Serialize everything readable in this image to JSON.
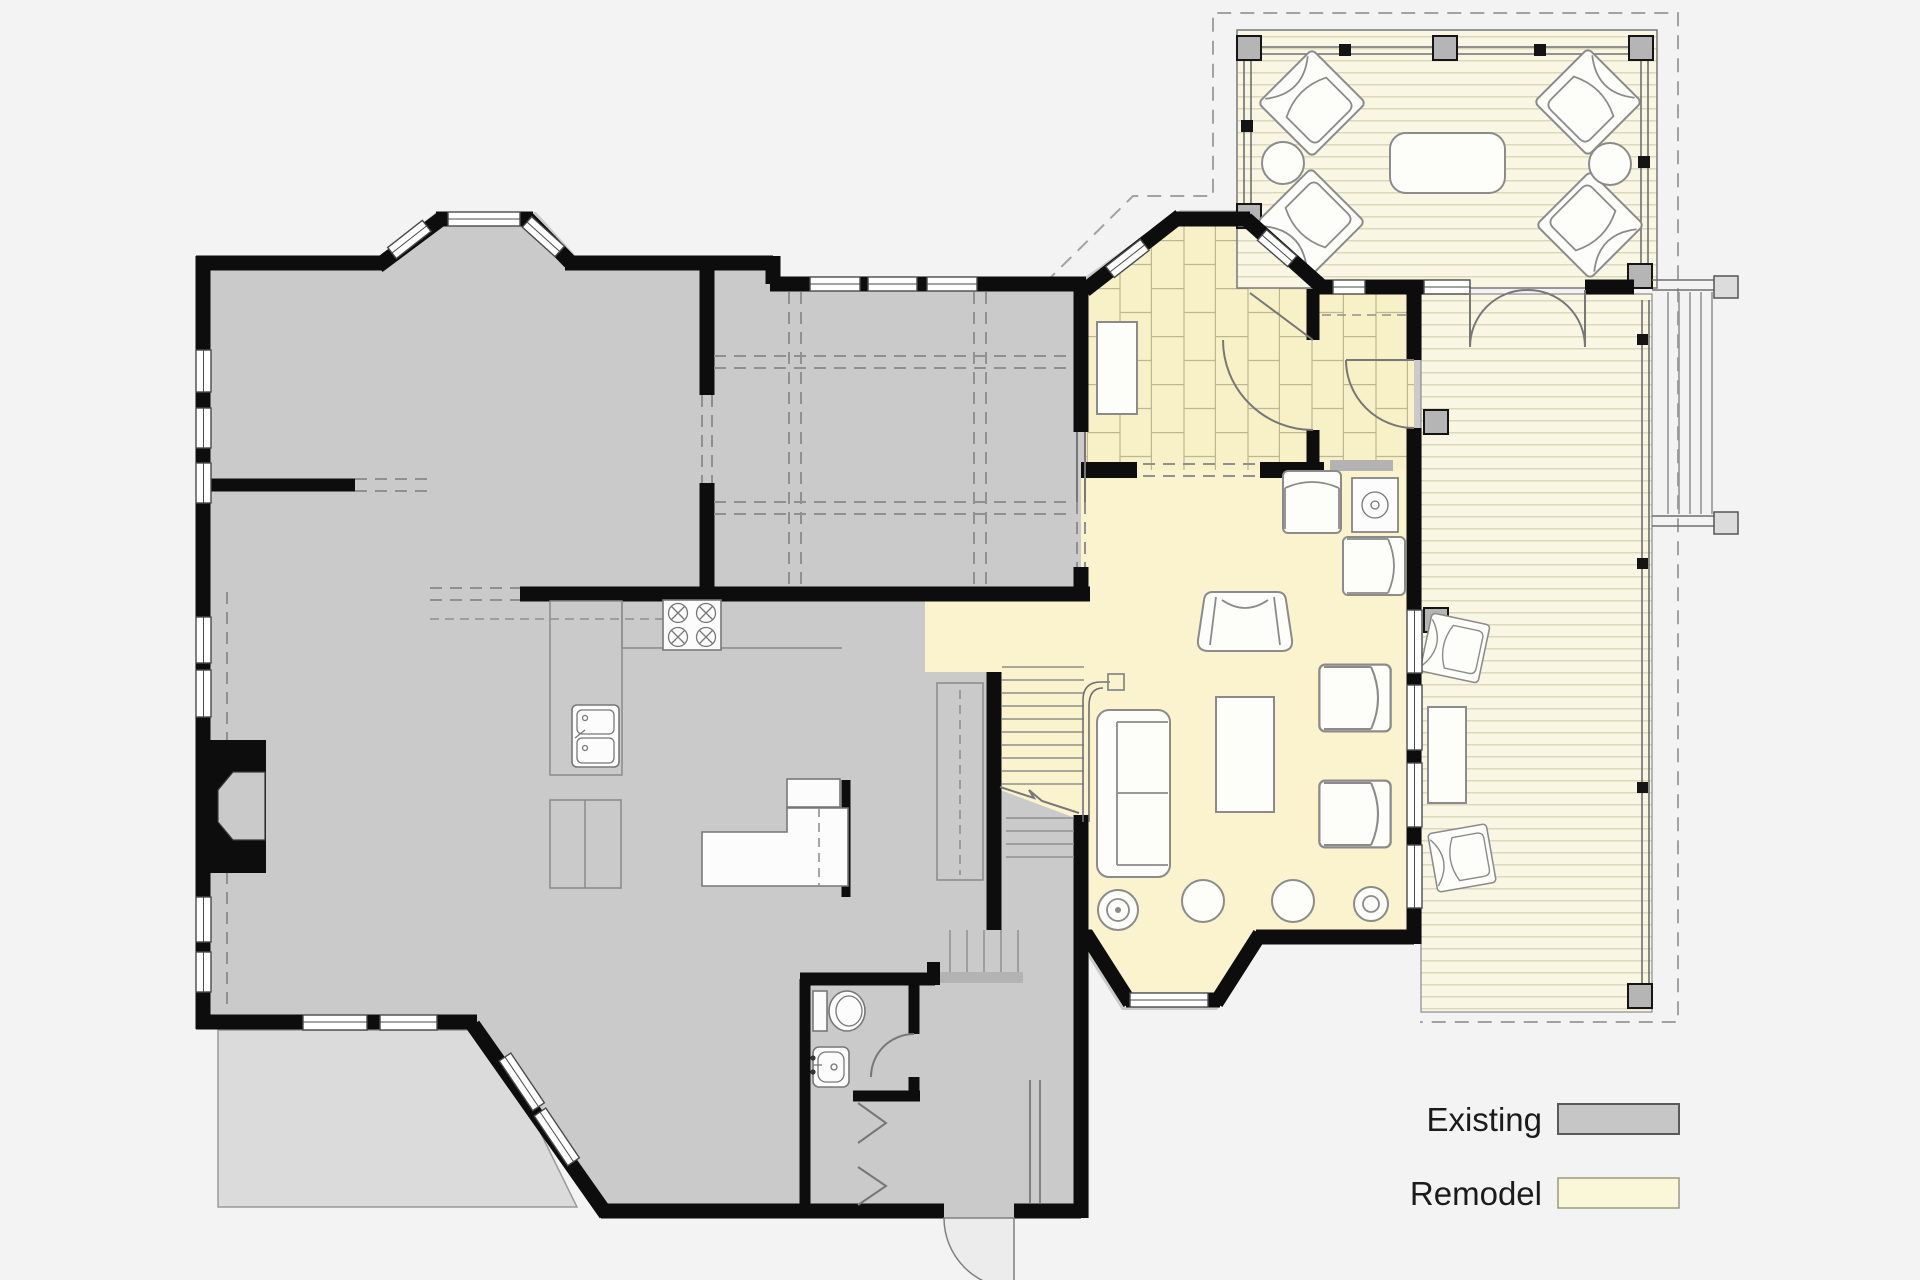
{
  "legend": {
    "items": [
      {
        "label": "Existing",
        "color": "#c6c6c6",
        "border": "#5a5a5a"
      },
      {
        "label": "Remodel",
        "color": "#faf7d9",
        "border": "#9a9a80"
      }
    ]
  },
  "colors": {
    "background": "#f3f3f4",
    "existing_fill": "#cacaca",
    "patio_fill": "#dbdbdb",
    "remodel_fill": "#faf3cd",
    "tile_fill": "#f8f1c7",
    "tile_line": "#bdb893",
    "porch_fill": "#f9f7e4",
    "board_line": "#dcd8bc",
    "wall": "#0d0d0d",
    "furn_fill": "#fdfdfa",
    "furn_stroke": "#8b8b8b",
    "dash": "#909090",
    "legend_text": "#1b1b1b"
  },
  "icons": {
    "stove": "stove-burners-icon",
    "sink": "kitchen-sink-icon",
    "toilet": "toilet-icon",
    "fireplace": "fireplace-icon",
    "wood_stove": "wood-stove-icon"
  }
}
